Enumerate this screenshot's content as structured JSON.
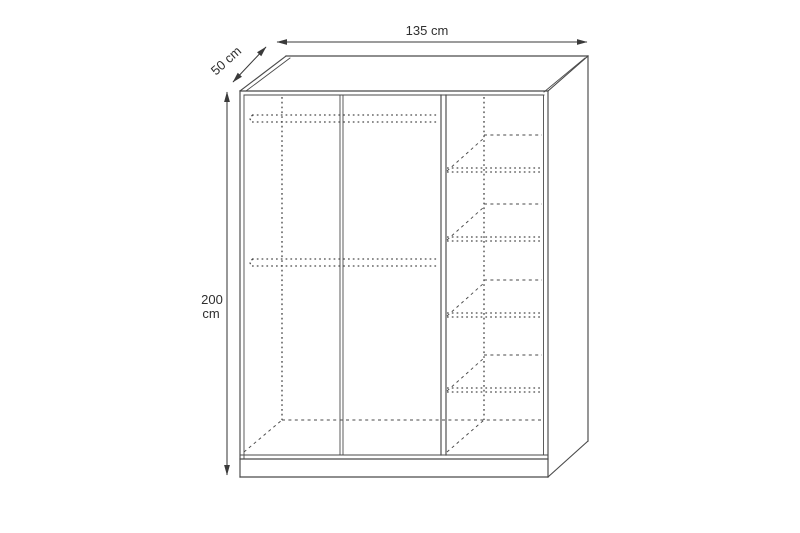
{
  "figure": {
    "type": "furniture-technical-drawing",
    "subject": "three-door wardrobe, front oblique view",
    "background_color": "#ffffff",
    "line_color": "#4a4a4a",
    "dimension_color": "#3a3a3a",
    "text_color": "#2f2f2f"
  },
  "dimensions": {
    "width_label": "135 cm",
    "depth_label": "50 cm",
    "height_value": "200",
    "height_unit": "cm"
  },
  "interior": {
    "door_sections": 3,
    "hanging_rail_count": 2,
    "shelf_count": 4,
    "hanging_rail_y": [
      115,
      259
    ],
    "hanging_rail_span": [
      252,
      438
    ],
    "shelf_front_y": [
      168,
      237,
      313,
      388
    ],
    "shelf_front_span": [
      447,
      542
    ],
    "shelf_back_span": [
      484,
      542
    ],
    "shelf_back_offset": {
      "dx": 37,
      "dy": -33
    }
  }
}
